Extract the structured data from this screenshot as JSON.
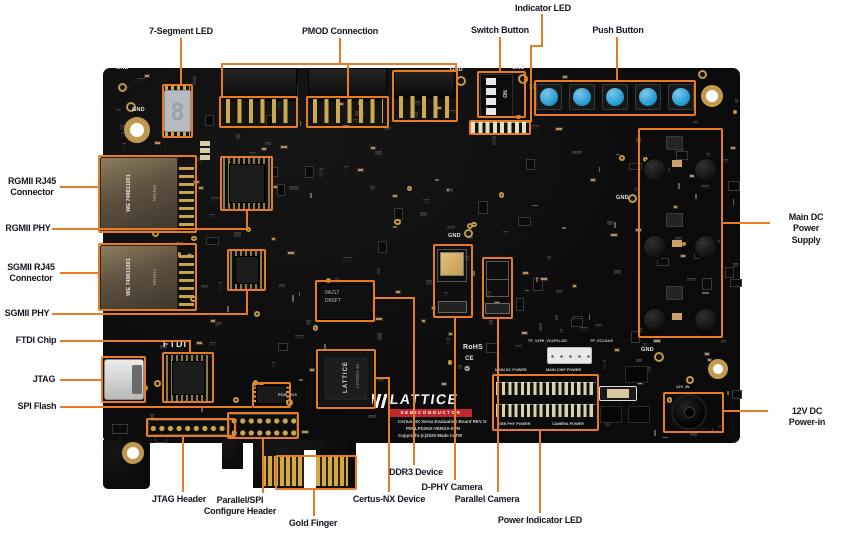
{
  "meta": {
    "accent": "#E87C25",
    "board_color": "#0e0e0e",
    "background": "#ffffff",
    "button_blue": "#2b9fd6"
  },
  "labels": {
    "seg7": "7-Segment LED",
    "pmod": "PMOD Connection",
    "switch": "Switch Button",
    "indled": "Indicator LED",
    "push": "Push Button",
    "rgmii_rj45": "RGMII RJ45\nConnector",
    "rgmii_phy": "RGMII PHY",
    "sgmii_rj45": "SGMII RJ45\nConnector",
    "sgmii_phy": "SGMII PHY",
    "ftdi": "FTDI Chip",
    "jtag": "JTAG",
    "spi": "SPI Flash",
    "jtag_hdr": "JTAG Header",
    "parspi": "Parallel/SPI\nConfigure Header",
    "gold": "Gold Finger",
    "certus": "Certus-NX Device",
    "ddr3": "DDR3 Device",
    "dphy": "D-PHY Camera",
    "parcam": "Parallel Camera",
    "pwrled": "Power Indicator LED",
    "maindc": "Main DC Power\nSupply",
    "v12": "12V DC Power-in"
  },
  "silk": {
    "gnd": "GND",
    "ftdi": "FTDI",
    "rohs": "RoHS",
    "ce": "CE",
    "recycle": "♲",
    "main_dc": "MAIN DC POWER",
    "main_chip": "MAIN CHIP POWER",
    "gbe": "GBE PHY POWER",
    "cam": "CAMERA POWER",
    "v12in": "12V_IN",
    "pcie": "PCIE_3V3",
    "on": "ON",
    "lattice": "LATTICE",
    "semi": "SEMICONDUCTOR",
    "title1": "Certus-NX Versa Evaluation Board REV D",
    "title2": "P/N:LFD2NX-VERSA-EVN",
    "title3": "Copyright (c)2020  Made in TW",
    "tp1": "TP_V1P8_VCCPLLSD",
    "tp2": "TP_VCCAUX"
  },
  "chips": {
    "seg7_digit": "8",
    "rj45_we": "WE  749811001",
    "rj45_a": "NR1943",
    "rj45_b": "NR1811",
    "certus1": "LATTICE",
    "certus2": "LFD2NX-40",
    "ddr1": "0AJ17",
    "ddr2": "D9SFT"
  },
  "decor": {
    "seed": 987654,
    "count": 300,
    "region": [
      108,
      73,
      627,
      364
    ],
    "keepout": [
      [
        368,
        386,
        145,
        56
      ],
      [
        486,
        362,
        118,
        74
      ],
      [
        158,
        80,
        40,
        62
      ],
      [
        534,
        78,
        165,
        42
      ]
    ],
    "dark": [
      "#1e1e1e",
      "#242424",
      "#2a2a2a",
      "#181818",
      "#303030"
    ],
    "tan": "#b9905a",
    "gold": "#c2983f",
    "silk": "rgba(255,255,255,0.35)"
  }
}
